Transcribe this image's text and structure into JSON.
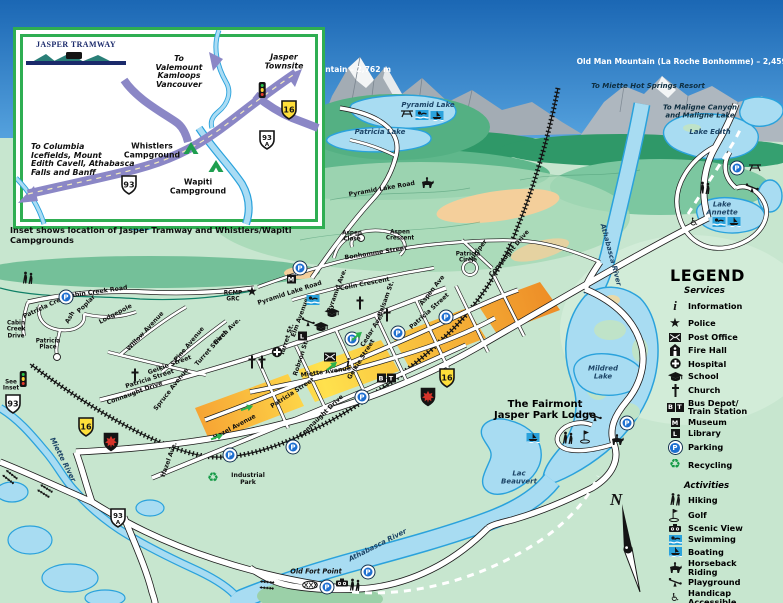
{
  "legend": {
    "title": "LEGEND",
    "services_title": "Services",
    "activities_title": "Activities",
    "services": [
      {
        "icon": "info",
        "label": "Information"
      },
      {
        "icon": "police",
        "label": "Police"
      },
      {
        "icon": "post-office",
        "label": "Post Office"
      },
      {
        "icon": "fire-hall",
        "label": "Fire Hall"
      },
      {
        "icon": "hospital",
        "label": "Hospital"
      },
      {
        "icon": "school",
        "label": "School"
      },
      {
        "icon": "church",
        "label": "Church"
      },
      {
        "icon": "bus-depot",
        "label": "Bus Depot/\nTrain Station"
      },
      {
        "icon": "museum",
        "label": "Museum"
      },
      {
        "icon": "library",
        "label": "Library"
      },
      {
        "icon": "parking",
        "label": "Parking"
      },
      {
        "icon": "recycling",
        "label": "Recycling"
      }
    ],
    "activities": [
      {
        "icon": "hiking",
        "label": "Hiking"
      },
      {
        "icon": "golf",
        "label": "Golf"
      },
      {
        "icon": "scenic",
        "label": "Scenic View"
      },
      {
        "icon": "swimming",
        "label": "Swimming"
      },
      {
        "icon": "boating",
        "label": "Boating"
      },
      {
        "icon": "horseback",
        "label": "Horseback\nRiding"
      },
      {
        "icon": "playground",
        "label": "Playground"
      },
      {
        "icon": "handicap",
        "label": "Handicap\nAccessible"
      }
    ]
  },
  "glyphs": {
    "parking": "P",
    "museum": "M",
    "library": "L",
    "bus": "B",
    "train": "T",
    "info": "i"
  },
  "inset": {
    "logo": "JASPER TRAMWAY",
    "caption": "Inset shows location of Jasper Tramway and Whistlers/Wapiti Campgrounds",
    "labels": [
      {
        "t": "To\nValemount\nKamloops\nVancouver",
        "x": 163,
        "y": 42,
        "c": "insdest"
      },
      {
        "t": "Jasper\nTownsite",
        "x": 268,
        "y": 32,
        "c": "insdest"
      },
      {
        "t": "To Columbia\nIcefields, Mount\nEdith Cavell, Athabasca\nFalls and Banff",
        "x": 15,
        "y": 130,
        "c": "insdest",
        "a": "left"
      },
      {
        "t": "Whistlers\nCampground",
        "x": 136,
        "y": 121,
        "c": "inscamp"
      },
      {
        "t": "Wapiti\nCampground",
        "x": 182,
        "y": 157,
        "c": "inscamp"
      }
    ],
    "shields": [
      {
        "type": "hwy16",
        "text": "16",
        "x": 273,
        "y": 80
      },
      {
        "type": "hwy93a",
        "text": "93",
        "sub": "A",
        "x": 251,
        "y": 110
      },
      {
        "type": "hwy93",
        "text": "93",
        "x": 113,
        "y": 155
      }
    ],
    "icons": [
      {
        "t": "tent",
        "x": 175,
        "y": 118
      },
      {
        "t": "tent",
        "x": 200,
        "y": 136
      },
      {
        "t": "traffic-light",
        "x": 246,
        "y": 60
      }
    ]
  },
  "map": {
    "compass_n": "N",
    "labels": [
      {
        "t": "Pyramid Mountain – 2,762 m",
        "x": 330,
        "y": 70,
        "r": 0,
        "c": "mtn"
      },
      {
        "t": "Old Man Mountain (La Roche Bonhomme) – 2,459 m",
        "x": 687,
        "y": 62,
        "r": 0,
        "c": "mtn"
      },
      {
        "t": "To Miette Hot Springs Resort",
        "x": 648,
        "y": 87,
        "r": 0,
        "c": "dest"
      },
      {
        "t": "To Maligne Canyon\nand Maligne Lake",
        "x": 700,
        "y": 112,
        "r": 0,
        "c": "dest"
      },
      {
        "t": "Pyramid Lake",
        "x": 428,
        "y": 106,
        "r": 0,
        "c": "water"
      },
      {
        "t": "Patricia Lake",
        "x": 380,
        "y": 133,
        "r": 0,
        "c": "water"
      },
      {
        "t": "Lake Edith",
        "x": 710,
        "y": 133,
        "r": 0,
        "c": "water"
      },
      {
        "t": "Lake\nAnnette",
        "x": 722,
        "y": 209,
        "r": 0,
        "c": "water"
      },
      {
        "t": "Mildred\nLake",
        "x": 603,
        "y": 373,
        "r": 0,
        "c": "water"
      },
      {
        "t": "Lac\nBeauvert",
        "x": 519,
        "y": 478,
        "r": 0,
        "c": "water"
      },
      {
        "t": "Athabasca River",
        "x": 610,
        "y": 255,
        "r": 75,
        "c": "water"
      },
      {
        "t": "Athabasca River",
        "x": 378,
        "y": 546,
        "r": -27,
        "c": "water"
      },
      {
        "t": "Miette River",
        "x": 62,
        "y": 460,
        "r": 63,
        "c": "water"
      },
      {
        "t": "The Fairmont\nJasper Park Lodge",
        "x": 545,
        "y": 410,
        "r": 0,
        "c": "big"
      },
      {
        "t": "Old Fort Point",
        "x": 316,
        "y": 572,
        "r": 0,
        "c": "pit"
      },
      {
        "t": "Industrial\nPark",
        "x": 248,
        "y": 480,
        "r": 0,
        "c": "road"
      },
      {
        "t": "RCMP\nGRC",
        "x": 233,
        "y": 297,
        "r": 0,
        "c": "tiny"
      },
      {
        "t": "See\nInset",
        "x": 11,
        "y": 386,
        "r": 0,
        "c": "tiny"
      },
      {
        "t": "Patricia\nCircle",
        "x": 468,
        "y": 258,
        "r": 0,
        "c": "tiny"
      },
      {
        "t": "Aspen\nClose",
        "x": 352,
        "y": 237,
        "r": 0,
        "c": "tiny"
      },
      {
        "t": "Aspen\nCrescent",
        "x": 400,
        "y": 236,
        "r": 0,
        "c": "tiny"
      },
      {
        "t": "Bonhomme Street",
        "x": 376,
        "y": 254,
        "r": -9,
        "c": "road"
      },
      {
        "t": "Colin Crescent",
        "x": 365,
        "y": 285,
        "r": -11,
        "c": "road"
      },
      {
        "t": "Juniper",
        "x": 479,
        "y": 251,
        "r": -52,
        "c": "road"
      },
      {
        "t": "Connaught Drive",
        "x": 510,
        "y": 254,
        "r": -50,
        "c": "road"
      },
      {
        "t": "Aspen Ave",
        "x": 433,
        "y": 291,
        "r": -52,
        "c": "road"
      },
      {
        "t": "Balsam St.",
        "x": 387,
        "y": 299,
        "r": -70,
        "c": "road"
      },
      {
        "t": "Patricia Street",
        "x": 430,
        "y": 312,
        "r": -42,
        "c": "road"
      },
      {
        "t": "Patricia Street",
        "x": 150,
        "y": 380,
        "r": -18,
        "c": "road"
      },
      {
        "t": "Patricia Street",
        "x": 293,
        "y": 394,
        "r": -33,
        "c": "road"
      },
      {
        "t": "Geikie Street",
        "x": 170,
        "y": 366,
        "r": -20,
        "c": "road"
      },
      {
        "t": "Geikie Street",
        "x": 362,
        "y": 360,
        "r": -58,
        "c": "road"
      },
      {
        "t": "Turret Street",
        "x": 212,
        "y": 349,
        "r": -48,
        "c": "road"
      },
      {
        "t": "Turret St.",
        "x": 288,
        "y": 340,
        "r": -72,
        "c": "road"
      },
      {
        "t": "Patricia Cres.",
        "x": 45,
        "y": 308,
        "r": -25,
        "c": "road"
      },
      {
        "t": "Poplar",
        "x": 87,
        "y": 305,
        "r": -45,
        "c": "road"
      },
      {
        "t": "Ash",
        "x": 71,
        "y": 318,
        "r": -60,
        "c": "road"
      },
      {
        "t": "Lodgepole",
        "x": 116,
        "y": 315,
        "r": -28,
        "c": "road"
      },
      {
        "t": "Willow Avenue",
        "x": 146,
        "y": 332,
        "r": -47,
        "c": "road"
      },
      {
        "t": "Cabin Creek Road",
        "x": 97,
        "y": 293,
        "r": -8,
        "c": "road"
      },
      {
        "t": "Cabin\nCreek\nDrive",
        "x": 16,
        "y": 330,
        "r": 0,
        "c": "tiny"
      },
      {
        "t": "Patricia\nPlace",
        "x": 48,
        "y": 345,
        "r": 0,
        "c": "tiny"
      },
      {
        "t": "Pine Avenue",
        "x": 190,
        "y": 345,
        "r": -50,
        "c": "road"
      },
      {
        "t": "Spruce Avenue",
        "x": 172,
        "y": 390,
        "r": -52,
        "c": "road"
      },
      {
        "t": "Connaught Drive",
        "x": 135,
        "y": 394,
        "r": -20,
        "c": "road"
      },
      {
        "t": "Connaught Drive",
        "x": 322,
        "y": 417,
        "r": -44,
        "c": "road"
      },
      {
        "t": "Hazel Avenue",
        "x": 235,
        "y": 428,
        "r": -28,
        "c": "road"
      },
      {
        "t": "Hazel Ave.",
        "x": 170,
        "y": 460,
        "r": -70,
        "c": "road"
      },
      {
        "t": "Miette Avenue",
        "x": 326,
        "y": 373,
        "r": -8,
        "c": "road"
      },
      {
        "t": "Cedar Ave.",
        "x": 373,
        "y": 331,
        "r": -58,
        "c": "road"
      },
      {
        "t": "Pyramid Lake Road",
        "x": 290,
        "y": 294,
        "r": -18,
        "c": "road"
      },
      {
        "t": "Pyramid Ave.",
        "x": 338,
        "y": 291,
        "r": -70,
        "c": "road"
      },
      {
        "t": "Elm Avenue",
        "x": 301,
        "y": 318,
        "r": -70,
        "c": "road"
      },
      {
        "t": "Pyramid Lake Road",
        "x": 382,
        "y": 190,
        "r": -10,
        "c": "road"
      },
      {
        "t": "Robson St.",
        "x": 302,
        "y": 358,
        "r": -72,
        "c": "road"
      },
      {
        "t": "Birch Ave.",
        "x": 228,
        "y": 332,
        "r": -45,
        "c": "road"
      }
    ],
    "shields": [
      {
        "type": "hwy93",
        "text": "93",
        "x": 13,
        "y": 404
      },
      {
        "type": "hwy16",
        "text": "16",
        "x": 86,
        "y": 427
      },
      {
        "type": "parks",
        "x": 111,
        "y": 442
      },
      {
        "type": "hwy16",
        "text": "16",
        "x": 447,
        "y": 378
      },
      {
        "type": "parks",
        "x": 428,
        "y": 397
      },
      {
        "type": "hwy93a",
        "text": "93",
        "sub": "A",
        "x": 118,
        "y": 518
      }
    ],
    "icons": [
      {
        "t": "parking",
        "x": 66,
        "y": 297
      },
      {
        "t": "parking",
        "x": 300,
        "y": 268
      },
      {
        "t": "parking",
        "x": 446,
        "y": 317
      },
      {
        "t": "parking",
        "x": 352,
        "y": 339
      },
      {
        "t": "parking",
        "x": 398,
        "y": 333
      },
      {
        "t": "parking",
        "x": 362,
        "y": 397
      },
      {
        "t": "parking",
        "x": 293,
        "y": 447
      },
      {
        "t": "parking",
        "x": 230,
        "y": 455
      },
      {
        "t": "parking",
        "x": 737,
        "y": 168
      },
      {
        "t": "parking",
        "x": 627,
        "y": 423
      },
      {
        "t": "parking",
        "x": 327,
        "y": 587
      },
      {
        "t": "parking",
        "x": 368,
        "y": 572
      },
      {
        "t": "church",
        "x": 360,
        "y": 303
      },
      {
        "t": "church",
        "x": 387,
        "y": 315
      },
      {
        "t": "church",
        "x": 252,
        "y": 362
      },
      {
        "t": "church",
        "x": 262,
        "y": 362
      },
      {
        "t": "church",
        "x": 135,
        "y": 375
      },
      {
        "t": "museum",
        "x": 291,
        "y": 279
      },
      {
        "t": "library",
        "x": 302,
        "y": 336
      },
      {
        "t": "hospital",
        "x": 277,
        "y": 352
      },
      {
        "t": "post-office",
        "x": 330,
        "y": 357
      },
      {
        "t": "info",
        "x": 348,
        "y": 363
      },
      {
        "t": "bus-depot",
        "x": 386,
        "y": 378
      },
      {
        "t": "police",
        "x": 252,
        "y": 292
      },
      {
        "t": "school",
        "x": 332,
        "y": 313
      },
      {
        "t": "school",
        "x": 321,
        "y": 327
      },
      {
        "t": "swimming",
        "x": 313,
        "y": 300
      },
      {
        "t": "swimming",
        "x": 422,
        "y": 115
      },
      {
        "t": "swimming",
        "x": 719,
        "y": 222
      },
      {
        "t": "boating",
        "x": 437,
        "y": 116
      },
      {
        "t": "boating",
        "x": 734,
        "y": 222
      },
      {
        "t": "boating",
        "x": 533,
        "y": 438
      },
      {
        "t": "horseback",
        "x": 427,
        "y": 183
      },
      {
        "t": "horseback",
        "x": 617,
        "y": 440
      },
      {
        "t": "hiking",
        "x": 28,
        "y": 278
      },
      {
        "t": "hiking",
        "x": 705,
        "y": 188
      },
      {
        "t": "hiking",
        "x": 568,
        "y": 438
      },
      {
        "t": "hiking",
        "x": 355,
        "y": 585
      },
      {
        "t": "golf",
        "x": 586,
        "y": 437
      },
      {
        "t": "scenic",
        "x": 342,
        "y": 583
      },
      {
        "t": "playground",
        "x": 308,
        "y": 322
      },
      {
        "t": "playground",
        "x": 595,
        "y": 417
      },
      {
        "t": "playground",
        "x": 752,
        "y": 188
      },
      {
        "t": "picnic",
        "x": 407,
        "y": 113
      },
      {
        "t": "picnic",
        "x": 755,
        "y": 167
      },
      {
        "t": "recycling",
        "x": 213,
        "y": 478
      },
      {
        "t": "handicap",
        "x": 694,
        "y": 222
      },
      {
        "t": "traffic-light",
        "x": 23,
        "y": 379
      },
      {
        "t": "arrow",
        "x": 247,
        "y": 408,
        "r": -20
      },
      {
        "t": "arrow",
        "x": 357,
        "y": 336,
        "r": -40
      },
      {
        "t": "arrow",
        "x": 332,
        "y": 366,
        "r": -40
      },
      {
        "t": "arrow",
        "x": 217,
        "y": 437,
        "r": -22
      },
      {
        "t": "bridge",
        "x": 10,
        "y": 477,
        "r": 38
      },
      {
        "t": "bridge",
        "x": 45,
        "y": 491,
        "r": 32
      },
      {
        "t": "bridge",
        "x": 267,
        "y": 585,
        "r": 5
      },
      {
        "t": "bridge-x",
        "x": 310,
        "y": 585,
        "r": 0
      }
    ]
  }
}
